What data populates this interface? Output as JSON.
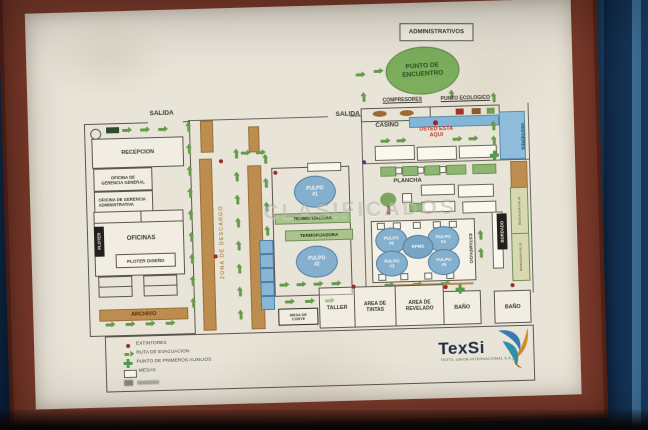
{
  "watermark": "CLASIFICADOS",
  "labels": {
    "administrativos": "ADMINISTRATIVOS",
    "punto_encuentro": "PUNTO DE ENCUENTRO",
    "salida_left": "SALIDA",
    "salida_center": "SALIDA",
    "recepcion": "RECEPCION",
    "oficina_gerencia_general": "OFICINA DE GERENCIA GENERAL",
    "oficina_gerencia_administrativa": "OFICINA DE GERENCIA ADMINISTRATIVA",
    "ploter": "PLOTER",
    "oficinas": "OFICINAS",
    "ploter_diseno": "PLOTER DISEÑO",
    "archivo": "ARCHIVO",
    "zona_descargo": "ZONA DE DESCARGO",
    "pulpo_1": "PULPO #1",
    "pulpo_2": "PULPO #2",
    "termofijadora_a": "TERMOFIJADORA",
    "termofijadora_b": "TERMOFIJADORA",
    "compresores": "COMPRESORES",
    "punto_ecologico": "PUNTO ECOLOGICO",
    "casino": "CASINO",
    "usted_esta_aqui": "USTED ESTA AQUI",
    "vestieres": "VESTIERES",
    "plancha": "PLANCHA",
    "estampado": "ESTAMPADO",
    "pulpo_6": "PULPO #6",
    "pulpo_4": "PULPO #4",
    "pulpo_3": "PULPO #3",
    "pulpo_5": "PULPO #5",
    "rpms": "RPMS",
    "bordado": "BORDADO",
    "bordadora_a": "BORDADORA DE 20",
    "bordadora_b": "BORDADORA DE 20",
    "mesa_de_corte": "MESA DE CORTE",
    "taller": "TALLER",
    "area_de_tintas": "AREA DE TINTAS",
    "area_de_revelado": "AREA DE REVELADO",
    "bano_1": "BAÑO",
    "bano_2": "BAÑO"
  },
  "legend": {
    "extintores": "EXTINTORES",
    "ruta_evacuacion": "RUTA DE EVACUACION",
    "primeros_auxilios": "PUNTO DE PRIMEROS AUXILIOS",
    "mesas": "MESAS"
  },
  "logo": {
    "name": "TexSi",
    "tagline": "TEXTIL UNION INTERNACIONAL S.A.S"
  },
  "colors": {
    "wall_blue": "#16395f",
    "frame_maroon": "#7a3a2b",
    "poster_beige": "#e9e4d8",
    "tan_zone": "#bd8c4f",
    "machine_blue": "#84afcd",
    "evac_green": "#679a4d",
    "alert_red": "#9c2a1e",
    "highlight_blue": "#82b5d6",
    "meeting_green": "#7cae5d"
  }
}
